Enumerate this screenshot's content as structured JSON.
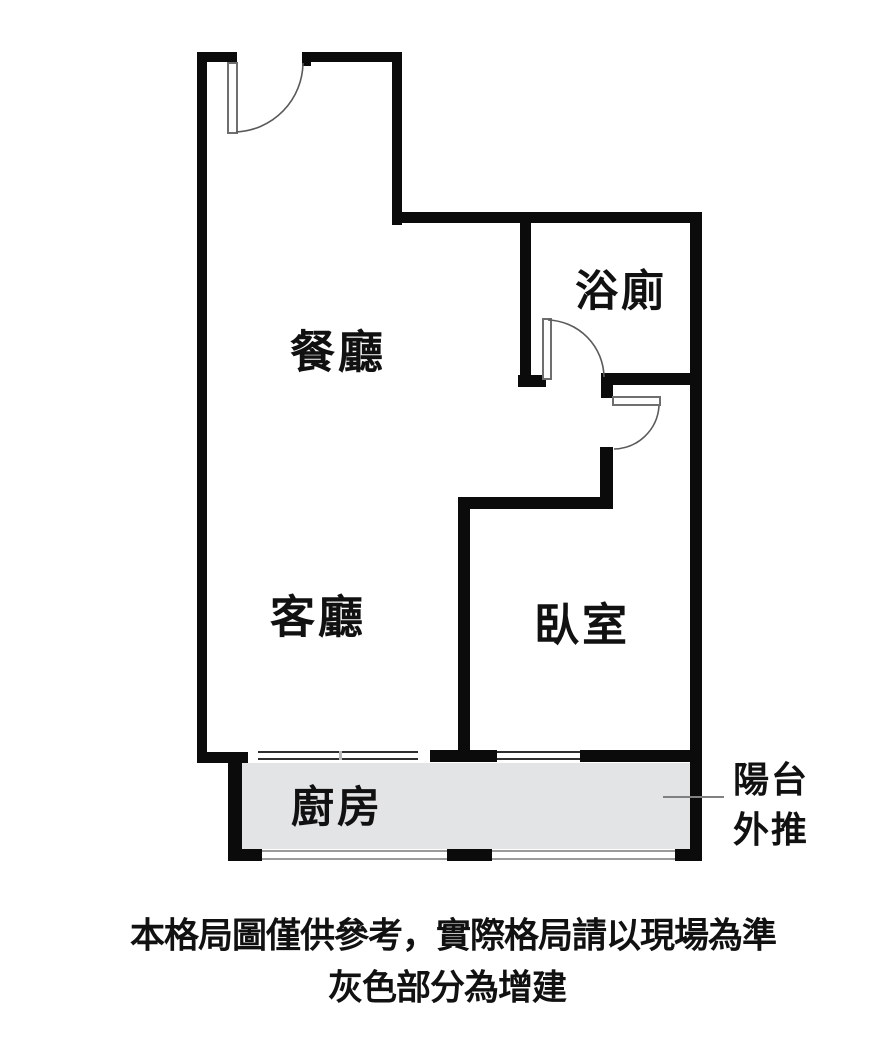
{
  "diagram_type": "apartment-floor-plan",
  "rooms": {
    "dining": {
      "label": "餐廳"
    },
    "bathroom": {
      "label": "浴廁"
    },
    "living": {
      "label": "客廳"
    },
    "bedroom": {
      "label": "臥室"
    },
    "kitchen": {
      "label": "廚房"
    }
  },
  "annotations": {
    "balcony": {
      "line1": "陽台",
      "line2": "外推"
    },
    "footer": {
      "line1": "本格局圖僅供參考，實際格局請以現場為準",
      "line2": "灰色部分為增建"
    }
  },
  "colors": {
    "wall": "#0b0b0b",
    "extension_fill": "#e3e4e6",
    "background": "#ffffff",
    "pointer_line": "#808080",
    "text": "#111111"
  }
}
